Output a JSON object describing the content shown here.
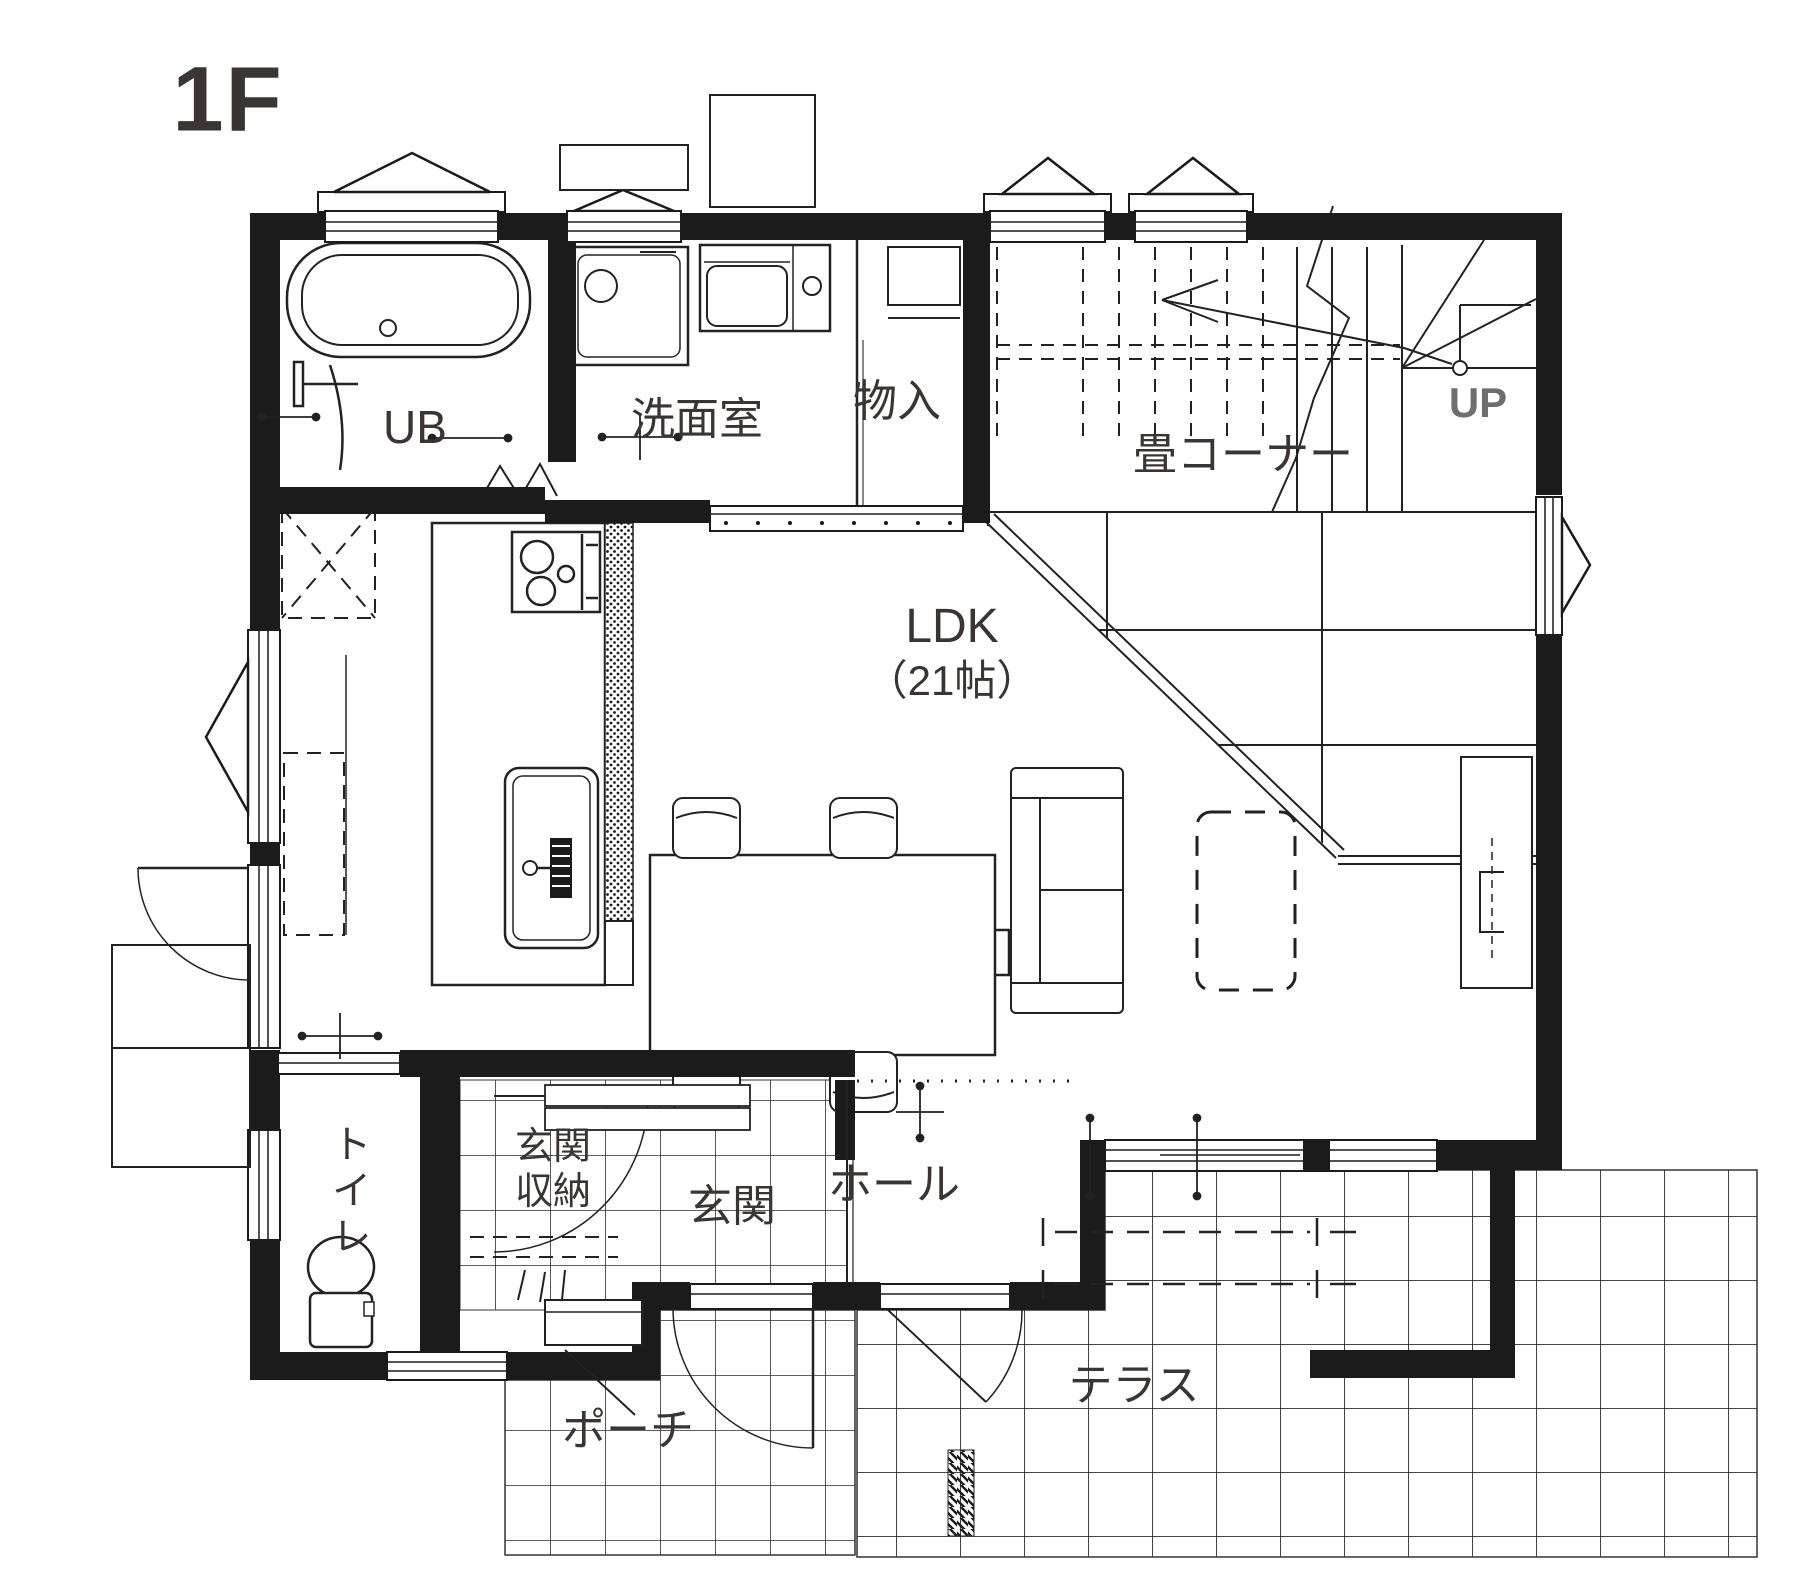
{
  "floor_plan": {
    "floor_label": "1F",
    "rooms": {
      "bath": {
        "label": "UB"
      },
      "washroom": {
        "label": "洗面室"
      },
      "storage": {
        "label": "物入"
      },
      "tatami_corner": {
        "label": "畳コーナー"
      },
      "stairs": {
        "label": "UP"
      },
      "ldk": {
        "label": "LDK",
        "size": "（21帖）"
      },
      "toilet": {
        "label": "トイレ"
      },
      "entry_storage": {
        "label": "玄関収納"
      },
      "entry": {
        "label": "玄関"
      },
      "hall": {
        "label": "ホール"
      },
      "porch": {
        "label": "ポーチ"
      },
      "terrace": {
        "label": "テラス"
      }
    },
    "colors": {
      "wall": "#1b1b1b",
      "line": "#222222",
      "text": "#3a3432",
      "up_text": "#6e6e6e",
      "background": "#ffffff"
    },
    "fixtures": [
      "bathtub-icon",
      "shower-mixer-icon",
      "folding-door-icon",
      "washing-machine-icon",
      "vanity-sink-icon",
      "closet-shelf-icon",
      "stairs-up-icon",
      "kitchen-stove-icon",
      "kitchen-sink-icon",
      "refrigerator-space-icon",
      "cupboard-space-icon",
      "dining-table-icon",
      "dining-chair-icon",
      "sofa-icon",
      "rug-icon",
      "tv-board-icon",
      "toilet-icon",
      "entrance-door-icon",
      "back-door-icon",
      "window-icon",
      "tile-floor",
      "tatami-mat",
      "water-heater-icon"
    ]
  }
}
